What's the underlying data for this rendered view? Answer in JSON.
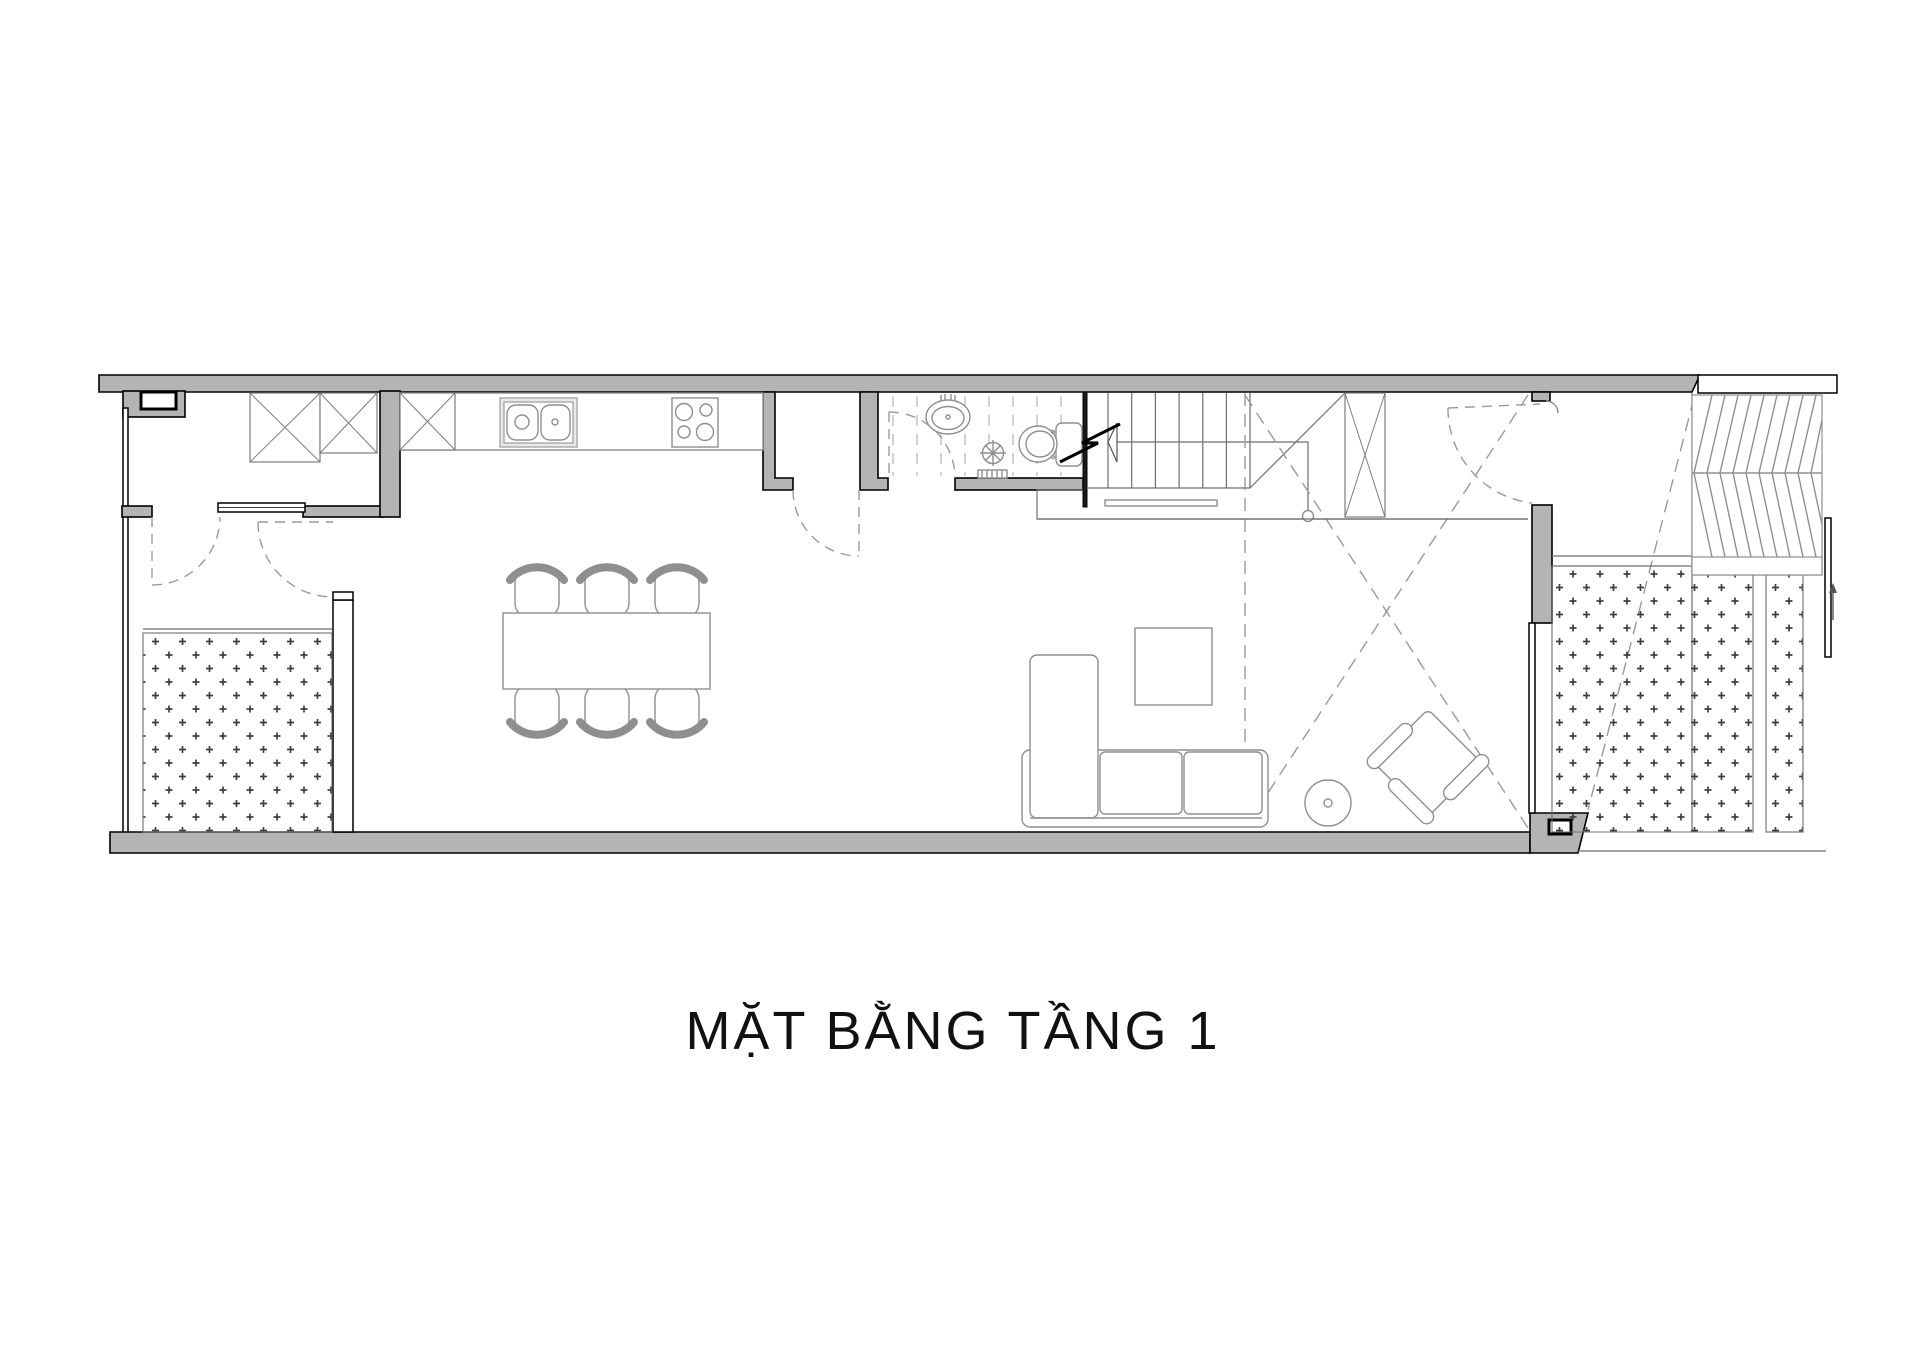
{
  "title": {
    "text": "MẶT BẰNG TẦNG 1"
  },
  "colors": {
    "paper": "#ffffff",
    "wall_fill": "#b4b4b4",
    "outline": "#000000",
    "furniture_line": "#8f8f8f",
    "dashed_line": "#9a9a9a",
    "hatch_dot": "#3f3f3f",
    "title_text": "#111111"
  },
  "drawing": {
    "type": "architectural-floor-plan",
    "floor_label": "MẶT BẰNG TẦNG 1",
    "rooms": {
      "utility_room": "top-left room with two wardrobes",
      "entry_hall": "lower-left room with dotted paving and two swing doors",
      "kitchen": "counter with double sink and 4-burner stove along top wall",
      "dining": "table with six chairs",
      "pantry": "small room between kitchen and bathroom with dashed door",
      "bathroom": "basin, shower drain and toilet, dashed tile lines",
      "stair": "straight flight with walk line, arrow and section zigzag",
      "living_room": "L-sofa, coffee table, round side table, rotated armchair, double-height void marked with dashed X",
      "porch": "dotted paving strips, chevron car ramp, gate arrow at right"
    }
  }
}
